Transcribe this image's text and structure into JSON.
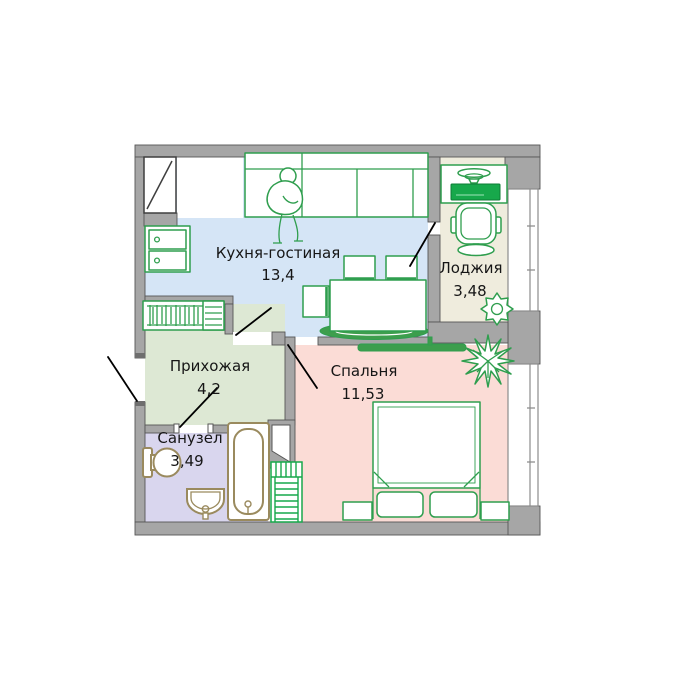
{
  "plan": {
    "type": "apartment-floor-plan",
    "rooms": [
      {
        "id": "kitchen-living",
        "name": "Кухня-гостиная",
        "area": "13,4",
        "fill": "#d5e5f6"
      },
      {
        "id": "loggia",
        "name": "Лоджия",
        "area": "3,48",
        "fill": "#efecdd"
      },
      {
        "id": "hallway",
        "name": "Прихожая",
        "area": "4,2",
        "fill": "#dde8d4"
      },
      {
        "id": "bedroom",
        "name": "Спальня",
        "area": "11,53",
        "fill": "#fbdcd6"
      },
      {
        "id": "bathroom",
        "name": "Санузел",
        "area": "3,49",
        "fill": "#d9d6ee"
      }
    ],
    "colors": {
      "wall": "#a6a6a6",
      "wall_outline": "#565656",
      "furniture_green": "#2f9e4e",
      "furniture_bright_green": "#17a84b",
      "sanitary_tan": "#9a8a5e",
      "door_line": "#000000",
      "label_text": "#161616",
      "background": "#ffffff"
    },
    "furniture_icons": [
      "sofa",
      "person",
      "kitchen-cabinet",
      "dining-table",
      "chair",
      "rug",
      "coat-rack",
      "desk",
      "desk-lamp",
      "laptop",
      "office-chair",
      "plant",
      "bed",
      "pillow",
      "nightstand",
      "shelf-rack",
      "wall-shelf",
      "bathtub",
      "toilet",
      "sink",
      "window",
      "door-swing"
    ]
  }
}
